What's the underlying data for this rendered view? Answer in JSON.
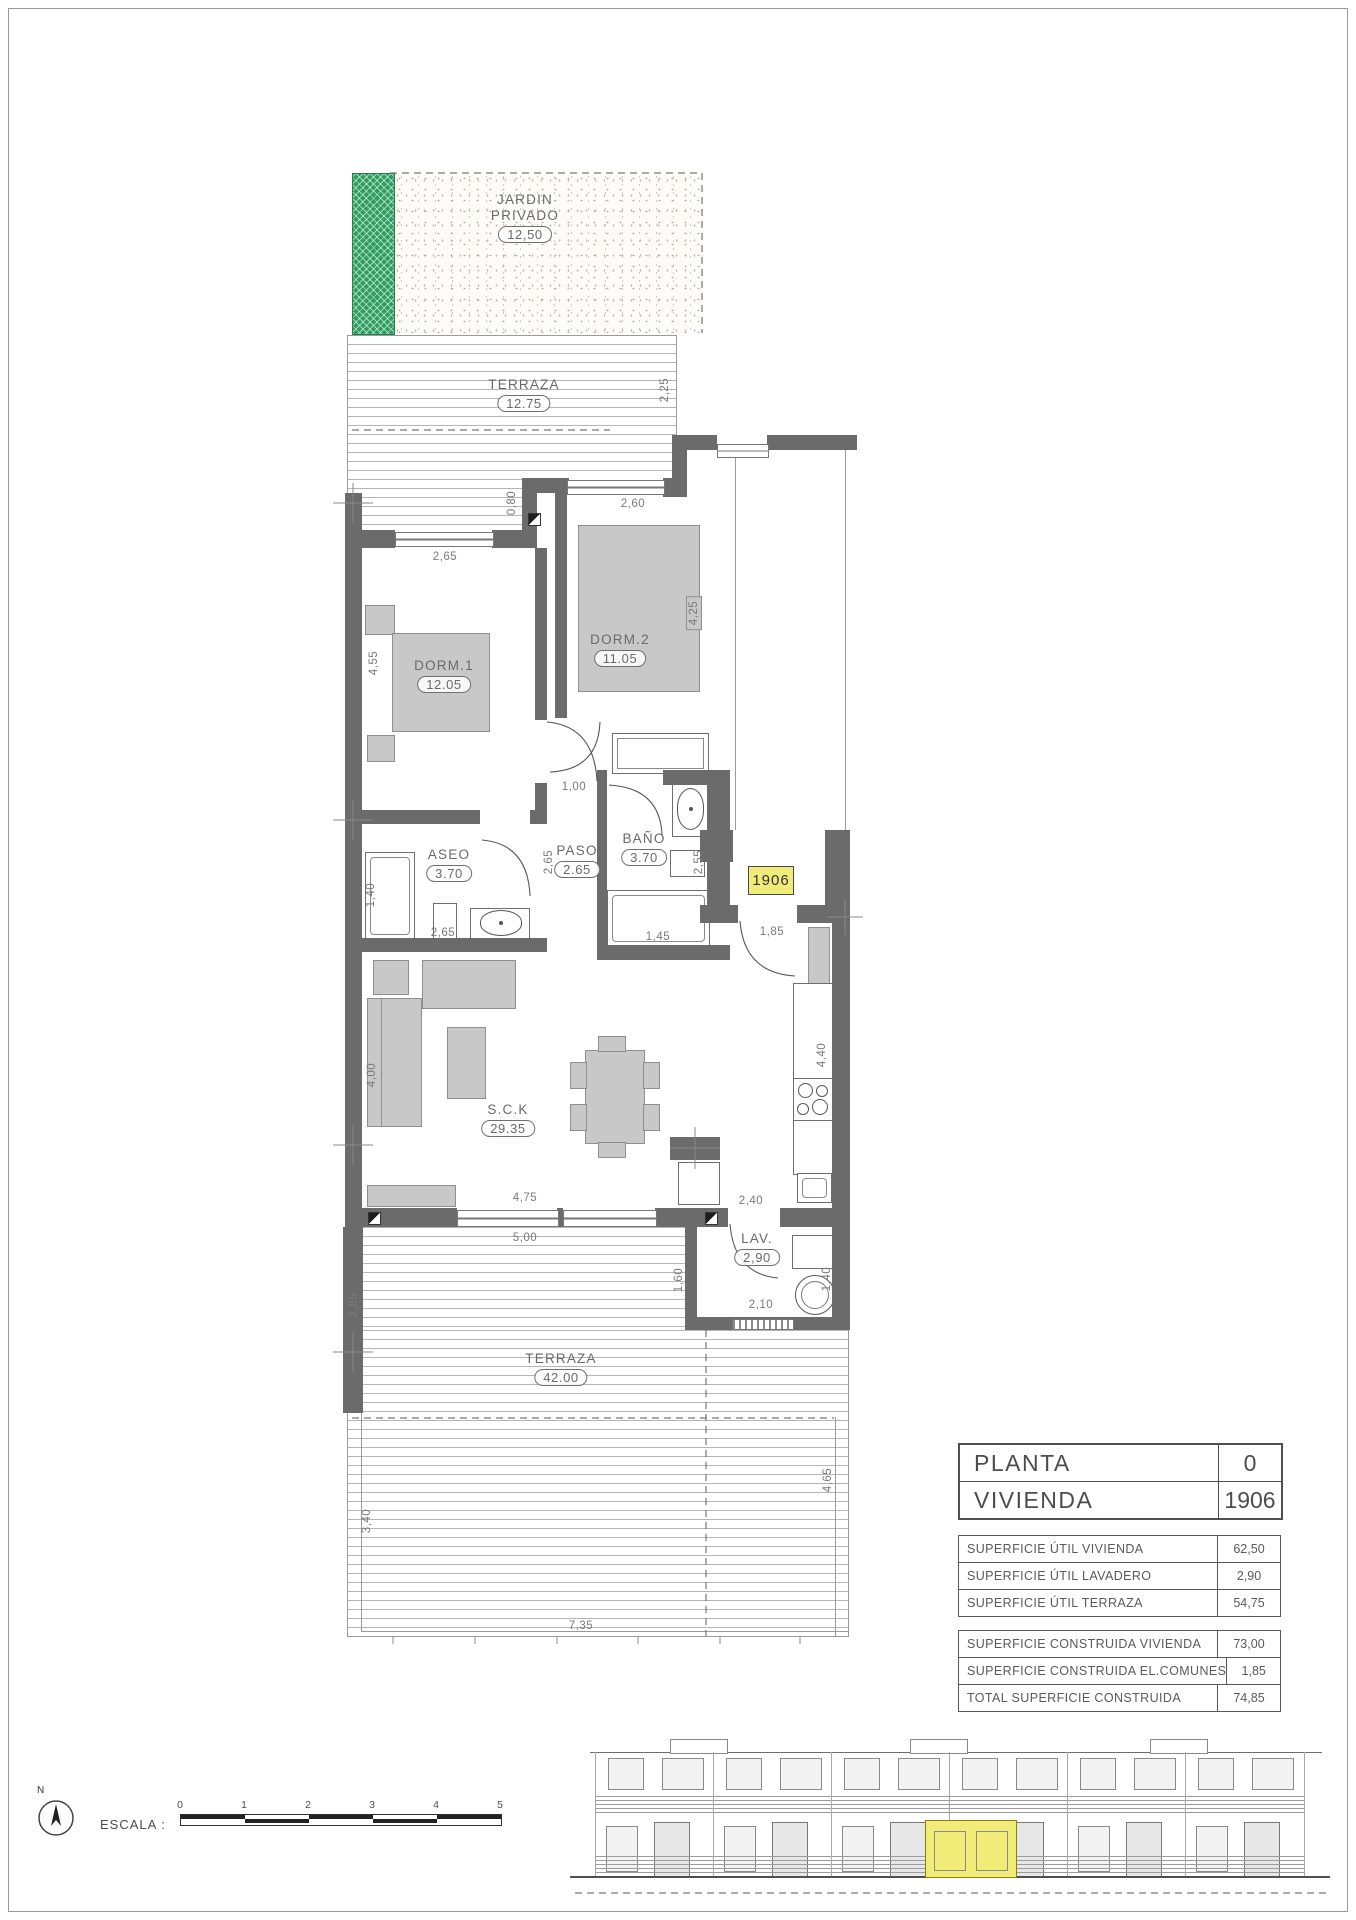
{
  "colors": {
    "wall": "#6b6b6b",
    "garden_green": "#2d9e5f",
    "highlight_yellow": "#f1ec77",
    "line": "#555555"
  },
  "plan": {
    "unit_tag": "1906",
    "rooms": [
      {
        "name": "JARDIN PRIVADO",
        "value": "12,50"
      },
      {
        "name": "TERRAZA",
        "value": "12.75"
      },
      {
        "name": "DORM.1",
        "value": "12.05"
      },
      {
        "name": "DORM.2",
        "value": "11.05"
      },
      {
        "name": "ASEO",
        "value": "3.70"
      },
      {
        "name": "PASO",
        "value": "2.65"
      },
      {
        "name": "BAÑO",
        "value": "3.70"
      },
      {
        "name": "S.C.K",
        "value": "29.35"
      },
      {
        "name": "LAV.",
        "value": "2,90"
      },
      {
        "name": "TERRAZA",
        "value": "42.00"
      }
    ],
    "dims": [
      {
        "t": "2,25"
      },
      {
        "t": "0,80"
      },
      {
        "t": "2,65"
      },
      {
        "t": "2,60"
      },
      {
        "t": "4,55"
      },
      {
        "t": "4,25"
      },
      {
        "t": "1,00"
      },
      {
        "t": "2,65"
      },
      {
        "t": "1,40"
      },
      {
        "t": "2,65"
      },
      {
        "t": "2,55"
      },
      {
        "t": "1,45"
      },
      {
        "t": "1,85"
      },
      {
        "t": "4,40"
      },
      {
        "t": "4,00"
      },
      {
        "t": "4,75"
      },
      {
        "t": "5,00"
      },
      {
        "t": "2,40"
      },
      {
        "t": "1,60"
      },
      {
        "t": "1,40"
      },
      {
        "t": "2,10"
      },
      {
        "t": "2,85"
      },
      {
        "t": "3,40"
      },
      {
        "t": "4,65"
      },
      {
        "t": "7,35"
      }
    ]
  },
  "info_table": {
    "rows": [
      {
        "label": "PLANTA",
        "value": "0"
      },
      {
        "label": "VIVIENDA",
        "value": "1906"
      }
    ]
  },
  "area_table_util": {
    "rows": [
      {
        "label": "SUPERFICIE ÚTIL VIVIENDA",
        "value": "62,50"
      },
      {
        "label": "SUPERFICIE ÚTIL LAVADERO",
        "value": "2,90"
      },
      {
        "label": "SUPERFICIE ÚTIL TERRAZA",
        "value": "54,75"
      }
    ]
  },
  "area_table_construida": {
    "rows": [
      {
        "label": "SUPERFICIE CONSTRUIDA VIVIENDA",
        "value": "73,00"
      },
      {
        "label": "SUPERFICIE CONSTRUIDA EL.COMUNES",
        "value": "1,85"
      },
      {
        "label": "TOTAL SUPERFICIE CONSTRUIDA",
        "value": "74,85"
      }
    ]
  },
  "footer": {
    "escala_label": "ESCALA :",
    "scale_ticks": [
      "0",
      "1",
      "2",
      "3",
      "4",
      "5"
    ],
    "north_label": "N"
  }
}
